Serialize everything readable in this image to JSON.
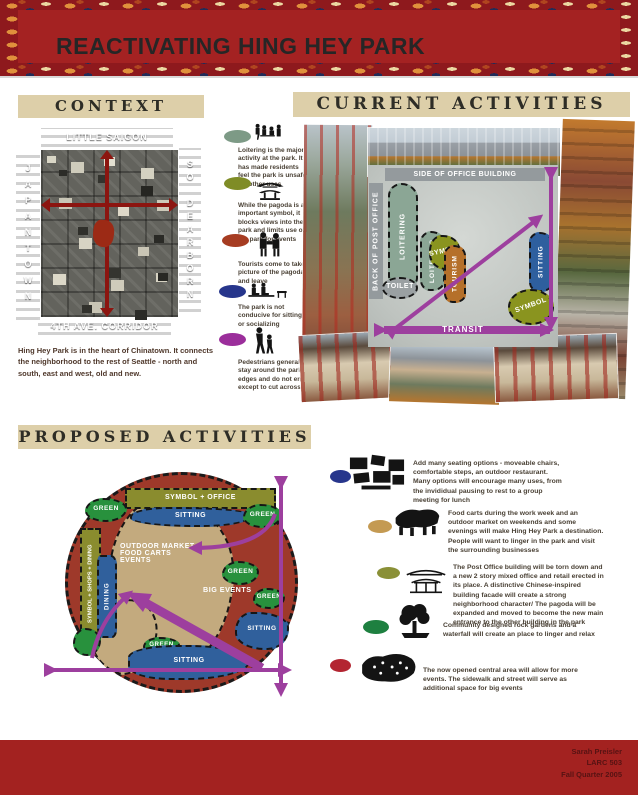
{
  "header": {
    "title": "REACTIVATING HING HEY PARK"
  },
  "context": {
    "title": "CONTEXT",
    "map": {
      "top_label": "LITTLE SAIGON",
      "left_label": "JAPANTOWN",
      "right_label": "SO DEARBORN",
      "bottom_label": "4TH AVE. CORRIDOR"
    },
    "caption": "Hing Hey Park is in the heart of Chinatown. It connects the neighborhood to the rest of Seattle -  north and south, east and west, old and new."
  },
  "observations": {
    "items": [
      {
        "icon": "loitering-people-icon",
        "color": "#7d9a86",
        "text": "Loitering is the major activity at the park. It has made residents feel the park is unsafe for other uses"
      },
      {
        "icon": "pagoda-icon",
        "color": "#7f8c26",
        "text": "While the pagoda is an important symbol, it blocks views into the park and limits use of the park for events"
      },
      {
        "icon": "tourist-people-icon",
        "color": "#a63c22",
        "text": "Tourists come to take a picture of the pagoda and leave"
      },
      {
        "icon": "sitting-people-icon",
        "color": "#27368c",
        "text": "The park is not conducive for sitting or socializing"
      },
      {
        "icon": "walking-people-icon",
        "color": "#9b2e9b",
        "text": "Pedestrians generally stay around the park's edges and do not enter except to cut across"
      }
    ]
  },
  "current": {
    "title": "CURRENT ACTIVITIES",
    "plan": {
      "office_side": "SIDE OF OFFICE BUILDING",
      "post_office": "BACK OF POST OFFICE",
      "loitering": "LOITERING",
      "toilet": "TOILET",
      "symbol": "SYMBOL",
      "tourism": "TOURISM",
      "sitting": "SITTING",
      "transit": "TRANSIT"
    }
  },
  "proposed": {
    "title": "PROPOSED ACTIVITIES",
    "diagram": {
      "symbol_office": "SYMBOL + OFFICE",
      "sitting": "SITTING",
      "green": "GREEN",
      "symbol_shops_dining": "SYMBOL + SHOPS + DINING",
      "dining": "DINING",
      "market_line1": "OUTDOOR MARKET",
      "market_line2": "FOOD CARTS",
      "market_line3": "EVENTS",
      "big_events": "BIG EVENTS"
    },
    "items": [
      {
        "icon": "seating-options-icon",
        "color": "#27368c",
        "text": "Add many seating options - moveable chairs, comfortable steps, an outdoor restaurant. Many options will encourage many uses, from the invididual pausing to rest to a group meeting for lunch"
      },
      {
        "icon": "food-carts-icon",
        "color": "#c49a52",
        "text": "Food carts during the work week and an outdoor market on weekends and some evenings will make Hing Hey Park a destination. People will want to linger in the park and visit the surrounding businesses"
      },
      {
        "icon": "new-building-icon",
        "color": "#8a9037",
        "text": "The Post Office building will be torn down and a new 2 story mixed office and retail erected in its place. A distinctive Chinese-inspired building facade will create a strong neighborhood character/ The pagoda will be expanded and moved to become the new main entrance to the other building in the park"
      },
      {
        "icon": "rock-garden-tree-icon",
        "color": "#1e8040",
        "text": "Community designed rock gardens and a waterfall will create an place to linger and relax"
      },
      {
        "icon": "big-events-crowd-icon",
        "color": "#b32531",
        "text": "The now opened central area will allow for more events. The sidewalk and street will serve as additional space for big events"
      }
    ]
  },
  "footer": {
    "author": "Sarah Preisler",
    "course": "LARC 503",
    "term": "Fall Quarter 2005"
  }
}
